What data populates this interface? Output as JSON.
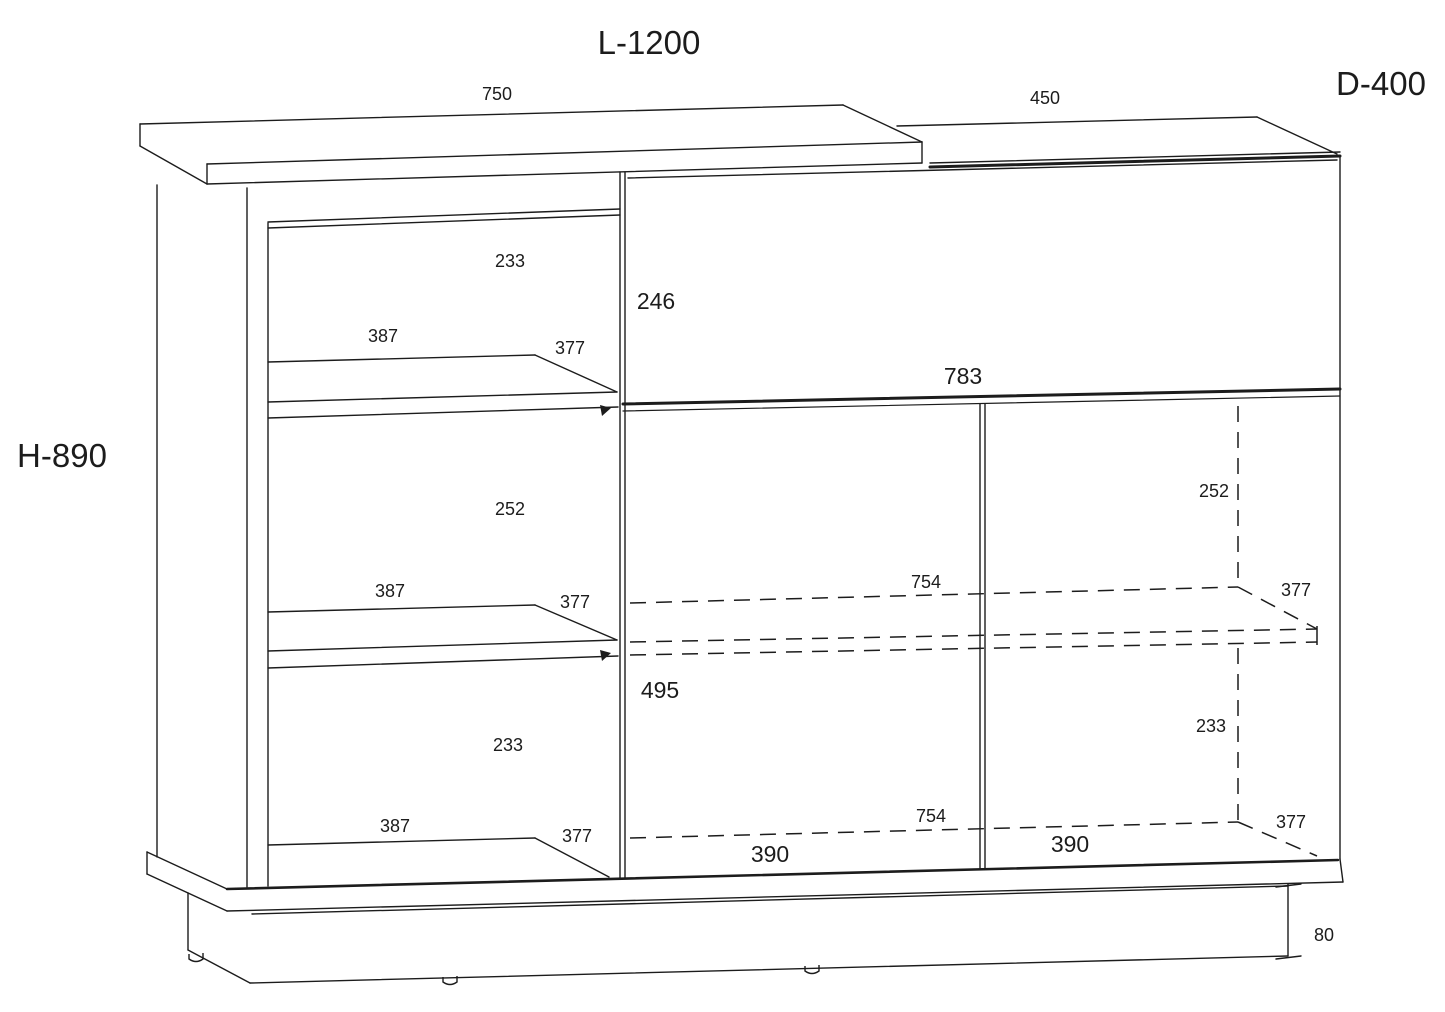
{
  "drawing": {
    "length_label": "L-1200",
    "depth_label": "D-400",
    "height_label": "H-890",
    "top": {
      "left_section_width": "750",
      "right_section_width": "450"
    },
    "left_shelves": {
      "top_compartment": {
        "height": "233",
        "width": "387",
        "depth": "377"
      },
      "middle_compartment": {
        "height": "252",
        "width": "387",
        "depth": "377"
      },
      "bottom_compartment": {
        "height": "233",
        "width": "387",
        "depth": "377"
      }
    },
    "right_section": {
      "flap_door_height": "246",
      "flap_door_width": "783",
      "upper_inner_height": "252",
      "upper_shelf_width": "754",
      "upper_shelf_depth": "377",
      "inner_height": "495",
      "lower_inner_height": "233",
      "lower_shelf_width": "754",
      "lower_shelf_depth": "377",
      "left_door_width": "390",
      "right_door_width": "390"
    },
    "plinth_height": "80"
  },
  "colors": {
    "line": "#1c1c1c",
    "background": "#ffffff"
  }
}
